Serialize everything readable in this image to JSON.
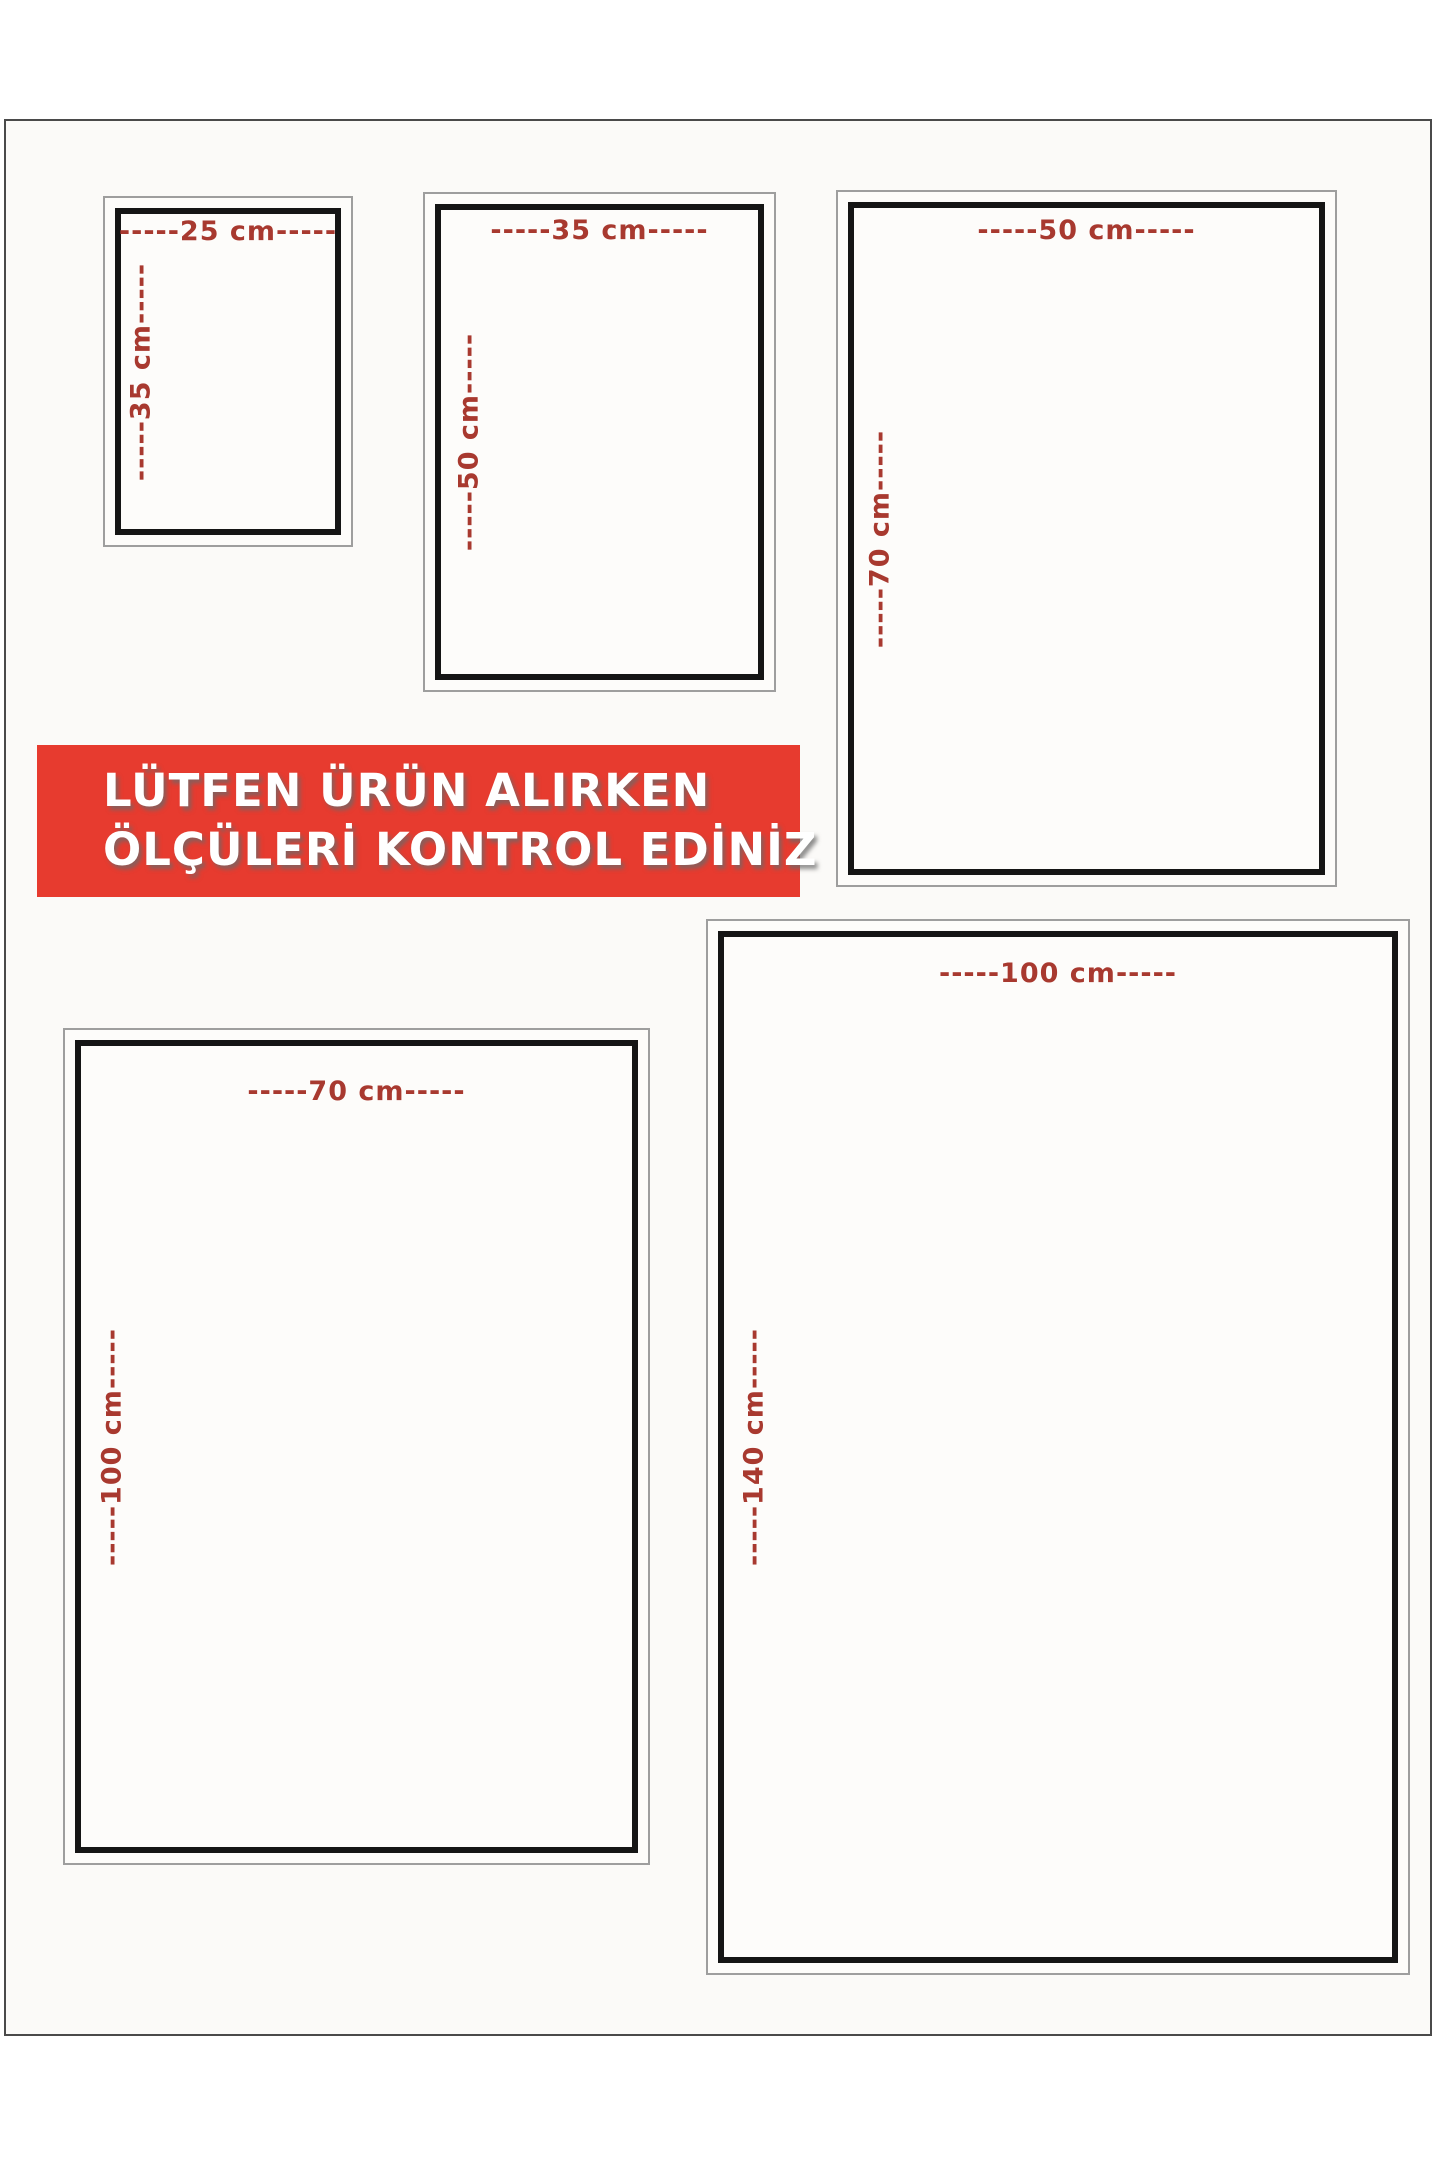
{
  "notice_banner": {
    "line1": "LÜTFEN ÜRÜN ALIRKEN",
    "line2": "ÖLÇÜLERİ KONTROL EDİNİZ",
    "background_color": "#e73b2f",
    "text_color": "#ffffff"
  },
  "colors": {
    "dimension_label": "#a8392f",
    "inner_border": "#151515",
    "outer_border": "#9e9e9e",
    "page_border": "#4a4a4a",
    "page_background": "#fbfaf8"
  },
  "size_boxes": [
    {
      "name": "25x35",
      "width_label": "-----25 cm-----",
      "height_label": "-----35 cm-----",
      "width_cm": 25,
      "height_cm": 35
    },
    {
      "name": "35x50",
      "width_label": "-----35 cm-----",
      "height_label": "-----50 cm-----",
      "width_cm": 35,
      "height_cm": 50
    },
    {
      "name": "50x70",
      "width_label": "-----50 cm-----",
      "height_label": "-----70 cm-----",
      "width_cm": 50,
      "height_cm": 70
    },
    {
      "name": "70x100",
      "width_label": "-----70 cm-----",
      "height_label": "-----100 cm-----",
      "width_cm": 70,
      "height_cm": 100
    },
    {
      "name": "100x140",
      "width_label": "-----100 cm-----",
      "height_label": "-----140 cm-----",
      "width_cm": 100,
      "height_cm": 140
    }
  ]
}
